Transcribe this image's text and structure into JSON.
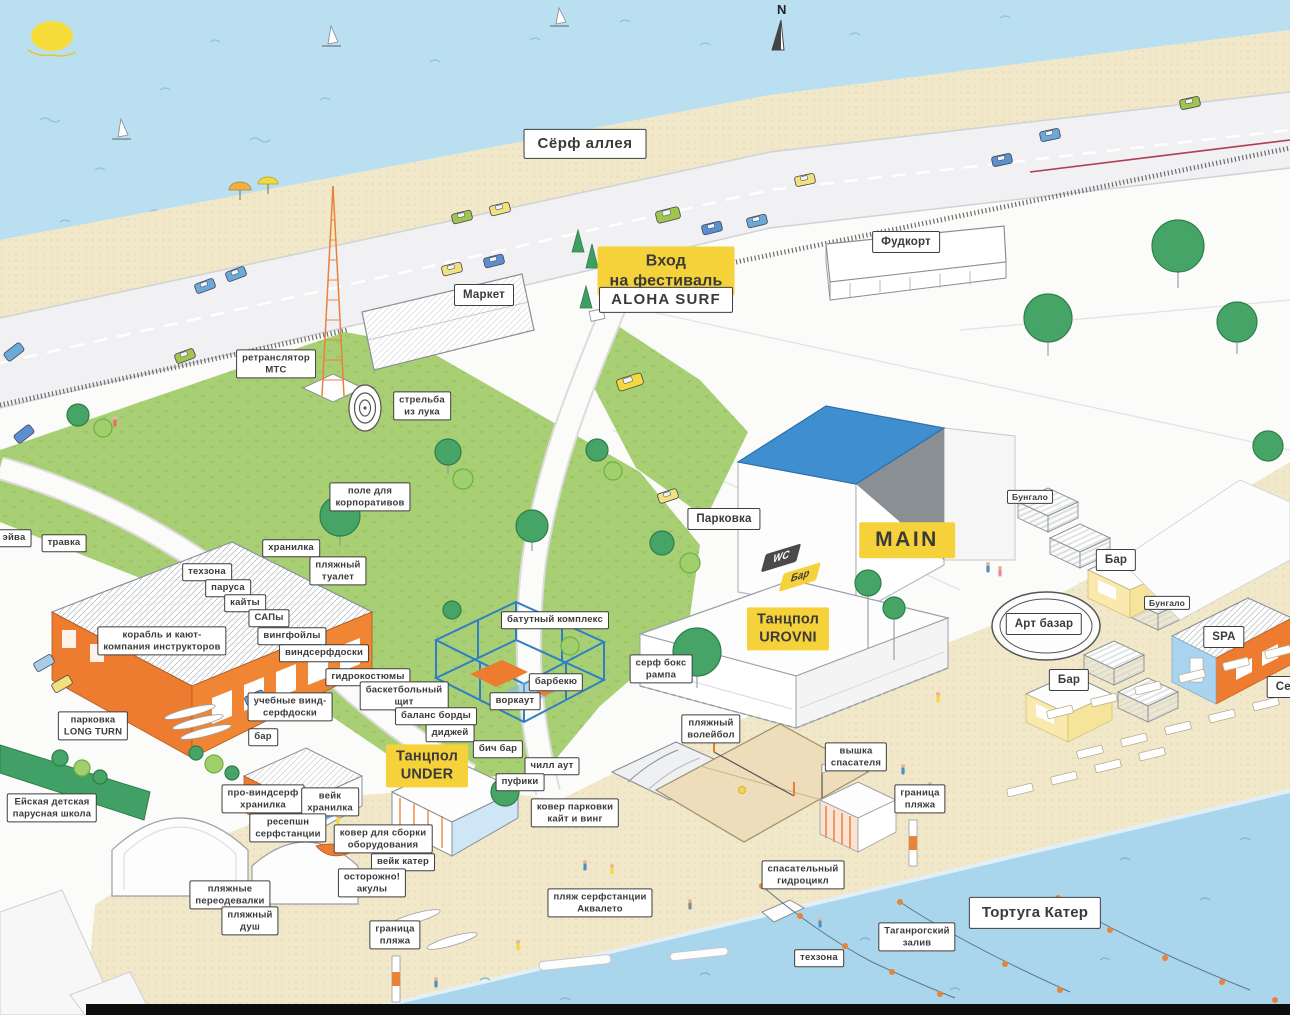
{
  "map": {
    "compass": "N",
    "colors": {
      "water": "#b9dff0",
      "sand": "#f1e7c9",
      "grass": "#a9cf74",
      "road": "#f1f0f3",
      "accent_orange": "#ed7b30",
      "label_yellow": "#f6d23a",
      "label_dark": "#4a4a4a",
      "roof_blue": "#3f8fd0",
      "ink": "#3a3a3a"
    },
    "labels": [
      {
        "name": "label-surf-alley",
        "text": "Сёрф аллея",
        "x": 585,
        "y": 144,
        "style": "plain-lg"
      },
      {
        "name": "label-market",
        "text": "Маркет",
        "x": 484,
        "y": 295,
        "style": "plain-md"
      },
      {
        "name": "label-foodcourt",
        "text": "Фудкорт",
        "x": 906,
        "y": 242,
        "style": "plain-md"
      },
      {
        "name": "label-entrance",
        "text": "Вход\nна фестиваль",
        "x": 666,
        "y": 271,
        "style": "yellow-lg"
      },
      {
        "name": "label-aloha-surf",
        "text": "ALOHA SURF",
        "x": 666,
        "y": 300,
        "style": "plain-lg"
      },
      {
        "name": "label-mts-tower",
        "text": "ретранслятор\nМТС",
        "x": 276,
        "y": 364,
        "style": "plain"
      },
      {
        "name": "label-archery",
        "text": "стрельба\nиз лука",
        "x": 422,
        "y": 406,
        "style": "plain"
      },
      {
        "name": "label-corporate-field",
        "text": "поле для\nкорпоративов",
        "x": 370,
        "y": 497,
        "style": "plain"
      },
      {
        "name": "label-parking",
        "text": "Парковка",
        "x": 724,
        "y": 519,
        "style": "plain-md"
      },
      {
        "name": "label-eyva",
        "text": "эйва",
        "x": 14,
        "y": 538,
        "style": "plain"
      },
      {
        "name": "label-grass",
        "text": "травка",
        "x": 64,
        "y": 543,
        "style": "plain"
      },
      {
        "name": "label-storage",
        "text": "хранилка",
        "x": 291,
        "y": 548,
        "style": "plain"
      },
      {
        "name": "label-techzone",
        "text": "техзона",
        "x": 207,
        "y": 572,
        "style": "plain"
      },
      {
        "name": "label-sails",
        "text": "паруса",
        "x": 228,
        "y": 588,
        "style": "plain"
      },
      {
        "name": "label-kites",
        "text": "кайты",
        "x": 245,
        "y": 603,
        "style": "plain"
      },
      {
        "name": "label-sups",
        "text": "САПы",
        "x": 269,
        "y": 618,
        "style": "plain"
      },
      {
        "name": "label-wingfoils",
        "text": "вингфойлы",
        "x": 292,
        "y": 636,
        "style": "plain"
      },
      {
        "name": "label-beach-wc",
        "text": "пляжный\nтуалет",
        "x": 338,
        "y": 571,
        "style": "plain"
      },
      {
        "name": "label-ship-instructors",
        "text": "корабль и кают-\nкомпания инструкторов",
        "x": 162,
        "y": 641,
        "style": "plain"
      },
      {
        "name": "label-windsurf-boards",
        "text": "виндсерфдоски",
        "x": 324,
        "y": 653,
        "style": "plain"
      },
      {
        "name": "label-wetsuits",
        "text": "гидрокостюмы",
        "x": 368,
        "y": 677,
        "style": "plain"
      },
      {
        "name": "label-training-boards",
        "text": "учебные винд-\nсерфдоски",
        "x": 290,
        "y": 707,
        "style": "plain"
      },
      {
        "name": "label-basketball",
        "text": "баскетбольный\nщит",
        "x": 404,
        "y": 696,
        "style": "plain"
      },
      {
        "name": "label-balance-boards",
        "text": "баланс борды",
        "x": 436,
        "y": 716,
        "style": "plain"
      },
      {
        "name": "label-dj",
        "text": "диджей",
        "x": 450,
        "y": 733,
        "style": "plain"
      },
      {
        "name": "label-bar-hangar",
        "text": "бар",
        "x": 263,
        "y": 737,
        "style": "plain"
      },
      {
        "name": "label-beach-bar",
        "text": "бич бар",
        "x": 498,
        "y": 749,
        "style": "plain"
      },
      {
        "name": "label-trampoline",
        "text": "батутный комплекс",
        "x": 555,
        "y": 620,
        "style": "plain"
      },
      {
        "name": "label-bbq",
        "text": "барбекю",
        "x": 556,
        "y": 682,
        "style": "plain"
      },
      {
        "name": "label-workout",
        "text": "воркаут",
        "x": 515,
        "y": 701,
        "style": "plain"
      },
      {
        "name": "label-surf-ramp",
        "text": "серф бокс\nрампа",
        "x": 661,
        "y": 669,
        "style": "plain"
      },
      {
        "name": "label-chill-out",
        "text": "чилл аут",
        "x": 552,
        "y": 766,
        "style": "plain"
      },
      {
        "name": "label-poufs",
        "text": "пуфики",
        "x": 520,
        "y": 782,
        "style": "plain"
      },
      {
        "name": "label-parking-long-turn",
        "text": "парковка\nLONG TURN",
        "x": 93,
        "y": 726,
        "style": "plain"
      },
      {
        "name": "label-sailing-school",
        "text": "Ейская детская\nпарусная школа",
        "x": 52,
        "y": 808,
        "style": "plain"
      },
      {
        "name": "label-pro-windsurf-storage",
        "text": "про-виндсерф\nхранилка",
        "x": 263,
        "y": 799,
        "style": "plain"
      },
      {
        "name": "label-wake-storage",
        "text": "вейк\nхранилка",
        "x": 330,
        "y": 802,
        "style": "plain"
      },
      {
        "name": "label-reception",
        "text": "ресепшн\nсерфстанции",
        "x": 288,
        "y": 828,
        "style": "plain"
      },
      {
        "name": "label-assembly-mat",
        "text": "ковер для сборки\nоборудования",
        "x": 383,
        "y": 839,
        "style": "plain"
      },
      {
        "name": "label-wake-boat",
        "text": "вейк катер",
        "x": 403,
        "y": 862,
        "style": "plain"
      },
      {
        "name": "label-sharks",
        "text": "осторожно!\nакулы",
        "x": 372,
        "y": 883,
        "style": "plain"
      },
      {
        "name": "label-changing-rooms",
        "text": "пляжные\nпереодевалки",
        "x": 230,
        "y": 895,
        "style": "plain"
      },
      {
        "name": "label-beach-shower",
        "text": "пляжный\nдуш",
        "x": 250,
        "y": 921,
        "style": "plain"
      },
      {
        "name": "label-beach-border-left",
        "text": "граница\nпляжа",
        "x": 395,
        "y": 935,
        "style": "plain"
      },
      {
        "name": "label-kite-parking-mat",
        "text": "ковер парковки\nкайт и винг",
        "x": 575,
        "y": 813,
        "style": "plain"
      },
      {
        "name": "label-aqualeto-beach",
        "text": "пляж серфстанции\nАквалето",
        "x": 600,
        "y": 903,
        "style": "plain"
      },
      {
        "name": "label-beach-volleyball",
        "text": "пляжный\nволейбол",
        "x": 711,
        "y": 729,
        "style": "plain"
      },
      {
        "name": "label-lifeguard-tower",
        "text": "вышка\nспасателя",
        "x": 856,
        "y": 757,
        "style": "plain"
      },
      {
        "name": "label-beach-border-right",
        "text": "граница\nпляжа",
        "x": 920,
        "y": 799,
        "style": "plain"
      },
      {
        "name": "label-rescue-jetski",
        "text": "спасательный\nгидроцикл",
        "x": 803,
        "y": 875,
        "style": "plain"
      },
      {
        "name": "label-techzone-water",
        "text": "техзона",
        "x": 819,
        "y": 958,
        "style": "plain"
      },
      {
        "name": "label-taganrog-bay",
        "text": "Таганрогский\nзалив",
        "x": 917,
        "y": 937,
        "style": "plain"
      },
      {
        "name": "label-tortuga-boat",
        "text": "Тортуга Катер",
        "x": 1035,
        "y": 913,
        "style": "plain-lg"
      },
      {
        "name": "label-bungalow-1",
        "text": "Бунгало",
        "x": 1030,
        "y": 497,
        "style": "plain-sm"
      },
      {
        "name": "label-bar-right-1",
        "text": "Бар",
        "x": 1116,
        "y": 560,
        "style": "plain-md"
      },
      {
        "name": "label-bungalow-2",
        "text": "Бунгало",
        "x": 1167,
        "y": 603,
        "style": "plain-sm"
      },
      {
        "name": "label-art-bazaar",
        "text": "Арт базар",
        "x": 1044,
        "y": 624,
        "style": "plain-md"
      },
      {
        "name": "label-bar-right-2",
        "text": "Бар",
        "x": 1069,
        "y": 680,
        "style": "plain-md"
      },
      {
        "name": "label-spa",
        "text": "SPA",
        "x": 1224,
        "y": 637,
        "style": "plain-md"
      },
      {
        "name": "label-serf-edge",
        "text": "Серф",
        "x": 1292,
        "y": 687,
        "style": "plain-md"
      },
      {
        "name": "label-main-stage",
        "text": "MAIN",
        "x": 907,
        "y": 540,
        "style": "yellow-xl"
      },
      {
        "name": "label-dancefloor-urovni",
        "text": "Танцпол\nUROVNI",
        "x": 788,
        "y": 629,
        "style": "yellow-md"
      },
      {
        "name": "label-dancefloor-under",
        "text": "Танцпол\nUNDER",
        "x": 427,
        "y": 766,
        "style": "yellow-md"
      },
      {
        "name": "label-wc",
        "text": "WC",
        "x": 781,
        "y": 558,
        "style": "dark-skew"
      },
      {
        "name": "label-bar-skew",
        "text": "Бар",
        "x": 800,
        "y": 577,
        "style": "yellow-skew"
      }
    ]
  }
}
